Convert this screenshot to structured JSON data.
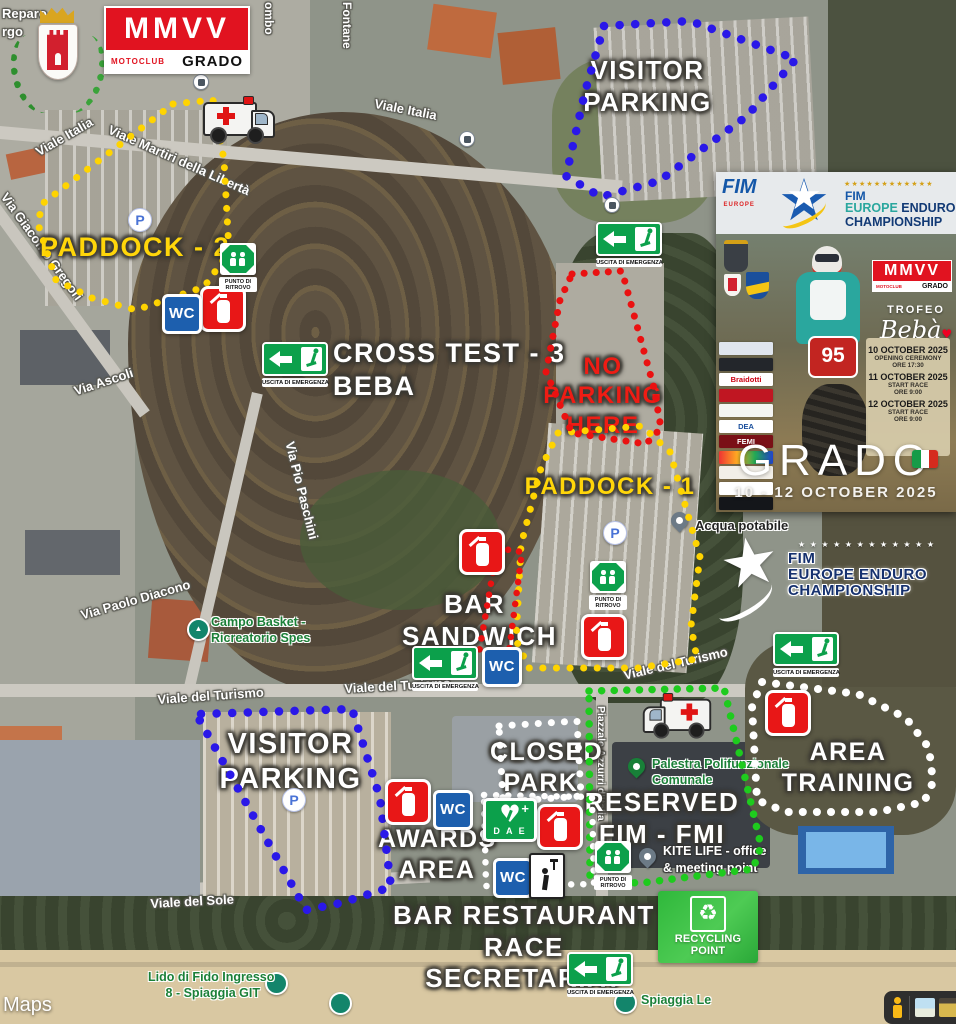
{
  "branding": {
    "mmvv_main": "MMVV",
    "mmvv_sub_left": "MOTOCLUB",
    "mmvv_sub_right": "GRADO"
  },
  "corner": {
    "line1": "Reparo",
    "line2": "rgo"
  },
  "streets": {
    "viale_italia": "Viale Italia",
    "viale_martiri": "Viale Martiri della Libertà",
    "colombo": "ombo",
    "fontane": "Fontane",
    "giacomo": "Via Giacomo Gregori",
    "ascoli": "Via Ascoli",
    "diacono": "Via Paolo Diacono",
    "paschini": "Via Pio Paschini",
    "turismo": "Viale del Turismo",
    "sole": "Viale del Sole",
    "piazzale": "Piazzale Azzurri d'Italia"
  },
  "zones": {
    "paddock2": "PADDOCK - 2",
    "paddock1": "PADDOCK - 1",
    "no_parking_l1": "NO PARKING",
    "no_parking_l2": "HERE",
    "visitor_l1": "VISITOR",
    "visitor_l2": "PARKING",
    "cross_l1": "CROSS TEST - 3",
    "cross_l2": "BEBA",
    "bar_l1": "BAR",
    "bar_l2": "SANDWICH",
    "closed_l1": "CLOSED",
    "closed_l2": "PARK",
    "training_l1": "AREA",
    "training_l2": "TRAINING",
    "reserved_l1": "RESERVED",
    "reserved_l2": "FIM - FMI",
    "awards_l1": "AWARDS",
    "awards_l2": "AREA",
    "barrest_l1": "BAR RESTAURANT",
    "barrest_l2": "RACE SECRETARIAT"
  },
  "pois": {
    "campo_l1": "Campo Basket -",
    "campo_l2": "Ricreatorio Spes",
    "acqua": "Acqua potabile",
    "palestra_l1": "Palestra Polifunzionale",
    "palestra_l2": "Comunale",
    "kite_l1": "KITE LIFE - office",
    "kite_l2": "& meeting point",
    "lido_l1": "Lido di Fido Ingresso",
    "lido_l2": "8 - Spiaggia GIT",
    "spiaggia": "Spiaggia Le"
  },
  "signs": {
    "uscita": "USCITA DI EMERGENZA",
    "punto_l1": "PUNTO DI",
    "punto_l2": "RITROVO",
    "wc": "WC",
    "dae": "D A E",
    "p": "P",
    "recycling": "RECYCLING POINT"
  },
  "fim_map_logo": {
    "stars": "★ ★ ★ ★ ★ ★ ★ ★ ★ ★ ★ ★",
    "line1": "FIM",
    "line2": "EUROPE ENDURO",
    "line3": "CHAMPIONSHIP"
  },
  "poster": {
    "fim_badge_name": "FIM",
    "fim_badge_region": "EUROPE",
    "stars": "★★★★★★★★★★★★",
    "title_l1": "FIM",
    "title_l2a": "EUROPE",
    "title_l2b": " ENDURO",
    "title_l3": "CHAMPIONSHIP",
    "mmvv_main": "MMVV",
    "mmvv_sub_left": "MOTOCLUB",
    "mmvv_sub_right": "GRADO",
    "trofeo": "TROFEO",
    "beba": "Bebà",
    "sponsor_1": "Braidotti",
    "sponsor_2": "DEA",
    "sponsor_3": "FEMI",
    "bib_number": "95",
    "schedule": [
      {
        "date": "10 OCTOBER 2025",
        "event": "OPENING CEREMONY",
        "time": "ORE 17:30"
      },
      {
        "date": "11 OCTOBER 2025",
        "event": "START RACE",
        "time": "ORE 9:00"
      },
      {
        "date": "12 OCTOBER 2025",
        "event": "START RACE",
        "time": "ORE 9:00"
      }
    ],
    "city": "GRADO",
    "date_range": "10 - 12 OCTOBER 2025"
  },
  "colors": {
    "paddock_yellow": "#ffd400",
    "parking_blue": "#2a18e8",
    "no_parking_red": "#ea1111",
    "reserved_green": "#1ecb1e",
    "zone_white": "#ffffff",
    "club_red": "#e11320"
  },
  "google": {
    "maps": "Maps"
  }
}
